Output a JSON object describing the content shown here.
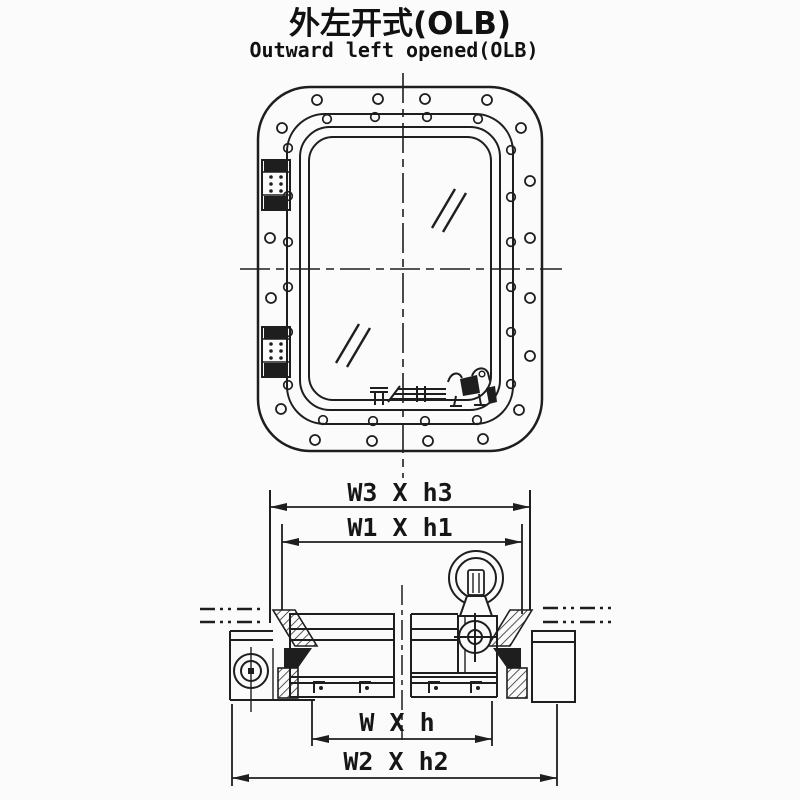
{
  "title": {
    "zh": "外左开式(OLB)",
    "en": "Outward left opened(OLB)"
  },
  "dimension_labels": {
    "bulkhead_cutout": "W3 X h3",
    "frame_outer": "W1 X h1",
    "clear_opening": "W X h",
    "overall_frame": "W2 X h2"
  },
  "colors": {
    "ink": "#1e1e1e",
    "background": "#fbfbfb"
  }
}
